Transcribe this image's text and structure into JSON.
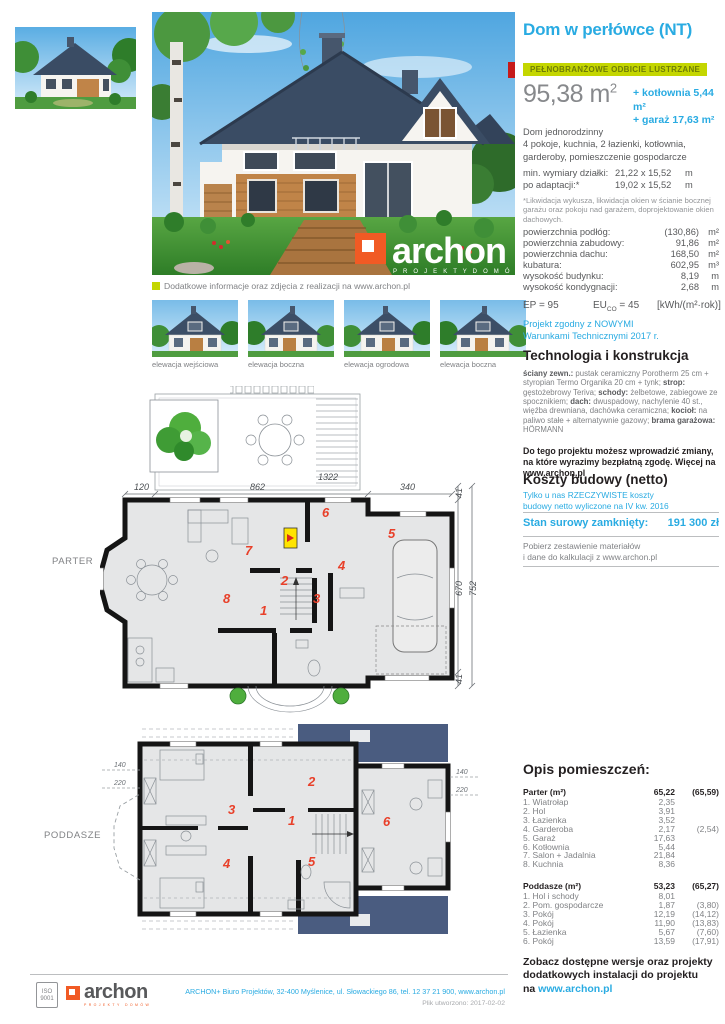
{
  "colors": {
    "accent_blue": "#29abe2",
    "badge_green": "#c4d600",
    "room_number_red": "#e8402a",
    "roof_navy": "#4a5c80"
  },
  "header": {
    "title": "Dom w perłówce (NT)",
    "badge": "PEŁNOBRANŻOWE ODBICIE LUSTRZANE",
    "area_value": "95,38 m",
    "area_sup": "2",
    "area_extras": "+ kotłownia 5,44 m²\n+ garaż 17,63 m²"
  },
  "description": "Dom jednorodzinny\n4 pokoje, kuchnia, 2 łazienki, kotłownia,\ngarderoby, pomieszczenie gospodarcze",
  "plot": {
    "rows": [
      {
        "label": "min. wymiary działki:",
        "value": "21,22 x 15,52",
        "unit": "m"
      },
      {
        "label": "po adaptacji:*",
        "value": "19,02 x 15,52",
        "unit": "m"
      }
    ],
    "footnote": "*Likwidacja wykusza, likwidacja okien w ścianie bocznej\ngarażu oraz pokoju nad garażem, doprojektowanie okien\ndachowych."
  },
  "areas": [
    {
      "label": "powierzchnia podłóg:",
      "value": "(130,86)",
      "unit": "m²"
    },
    {
      "label": "powierzchnia zabudowy:",
      "value": "91,86",
      "unit": "m²"
    },
    {
      "label": "powierzchnia dachu:",
      "value": "168,50",
      "unit": "m²"
    },
    {
      "label": "kubatura:",
      "value": "602,95",
      "unit": "m³"
    },
    {
      "label": "wysokość budynku:",
      "value": "8,19",
      "unit": "m"
    },
    {
      "label": "wysokość kondygnacji:",
      "value": "2,68",
      "unit": "m"
    }
  ],
  "energy": {
    "ep": "EP = 95",
    "eu_label": "EU",
    "eu_sub": "CO",
    "eu_eq": " = 45",
    "unit": "[kWh/(m²·rok)]"
  },
  "wt2017": "Projekt zgodny z NOWYMI\nWarunkami Technicznymi 2017 r.",
  "tech": {
    "heading": "Technologia i konstrukcja",
    "seg": [
      {
        "b": "ściany zewn.:",
        "t": " pustak ceramiczny Porotherm 25 cm + styropian Termo Organika 20 cm + tynk; "
      },
      {
        "b": "strop:",
        "t": " gęstożebrowy Teriva; "
      },
      {
        "b": "schody:",
        "t": " żelbetowe, zabiegowe ze spocznikiem; "
      },
      {
        "b": "dach:",
        "t": " dwuspadowy, nachylenie 40 st., więźba drewniana, dachówka ceramiczna; "
      },
      {
        "b": "kocioł:",
        "t": " na paliwo stałe + alternatywnie gazowy; "
      },
      {
        "b": "brama garażowa:",
        "t": " HÖRMANN"
      }
    ],
    "note": "Do tego projektu możesz wprowadzić zmiany, na które wyrazimy bezpłatną zgodę. Więcej na www.archon.pl"
  },
  "koszty": {
    "heading": "Koszty budowy (netto)",
    "sub": "Tylko u nas RZECZYWISTE koszty\nbudowy netto wyliczone na IV kw. 2016",
    "stan_label": "Stan surowy zamknięty:",
    "stan_value": "191 300 zł",
    "pobierz": "Pobierz zestawienie materiałów\ni dane do kalkulacji z www.archon.pl"
  },
  "infoline": "Dodatkowe informacje oraz zdjęcia z realizacji na www.archon.pl",
  "elevations": [
    "elewacja wejściowa",
    "elewacja boczna",
    "elewacja ogrodowa",
    "elewacja boczna"
  ],
  "photo_watermark": {
    "word": "archon",
    "sub": "P R O J E K T Y   D O M Ó W"
  },
  "rooms": {
    "heading": "Opis pomieszczeń:",
    "parter_head": {
      "name": "Parter (m²)",
      "v1": "65,22",
      "v2": "(65,59)"
    },
    "parter": [
      {
        "name": "1. Wiatrołap",
        "v1": "2,35",
        "v2": ""
      },
      {
        "name": "2. Hol",
        "v1": "3,91",
        "v2": ""
      },
      {
        "name": "3. Łazienka",
        "v1": "3,52",
        "v2": ""
      },
      {
        "name": "4. Garderoba",
        "v1": "2,17",
        "v2": "(2,54)"
      },
      {
        "name": "5. Garaż",
        "v1": "17,63",
        "v2": ""
      },
      {
        "name": "6. Kotłownia",
        "v1": "5,44",
        "v2": ""
      },
      {
        "name": "7. Salon + Jadalnia",
        "v1": "21,84",
        "v2": ""
      },
      {
        "name": "8. Kuchnia",
        "v1": "8,36",
        "v2": ""
      }
    ],
    "poddasze_head": {
      "name": "Poddasze (m²)",
      "v1": "53,23",
      "v2": "(65,27)"
    },
    "poddasze": [
      {
        "name": "1. Hol i schody",
        "v1": "8,01",
        "v2": ""
      },
      {
        "name": "2. Pom. gospodarcze",
        "v1": "1,87",
        "v2": "(3,80)"
      },
      {
        "name": "3. Pokój",
        "v1": "12,19",
        "v2": "(14,12)"
      },
      {
        "name": "4. Pokój",
        "v1": "11,90",
        "v2": "(13,83)"
      },
      {
        "name": "5. Łazienka",
        "v1": "5,67",
        "v2": "(7,60)"
      },
      {
        "name": "6. Pokój",
        "v1": "13,59",
        "v2": "(17,91)"
      }
    ]
  },
  "cta": {
    "text": "Zobacz dostępne wersje oraz projekty\ndodatkowych instalacji do projektu\nna ",
    "link": "www.archon.pl"
  },
  "plans": {
    "parter": {
      "label": "PARTER",
      "dim_total": "1322",
      "dims_top": [
        "120",
        "862",
        "340"
      ],
      "dims_right": [
        "41",
        "670",
        "752",
        "41"
      ],
      "rooms": [
        "1",
        "2",
        "3",
        "4",
        "5",
        "6",
        "7",
        "8"
      ]
    },
    "poddasze": {
      "label": "PODDASZE",
      "dims_left": [
        "140",
        "220"
      ],
      "dims_right": [
        "140",
        "220"
      ],
      "rooms": [
        "1",
        "2",
        "3",
        "4",
        "5",
        "6"
      ]
    }
  },
  "footer": {
    "iso1": "ISO",
    "iso2": "9001",
    "logo_word": "archon",
    "logo_sub": "PROJEKTY DOMÓW",
    "address": "ARCHON+ Biuro Projektów,  32-400 Myślenice,  ul. Słowackiego 86,  tel. 12 37 21 900, www.archon.pl",
    "file": "Plik utworzono: 2017-02-02"
  }
}
